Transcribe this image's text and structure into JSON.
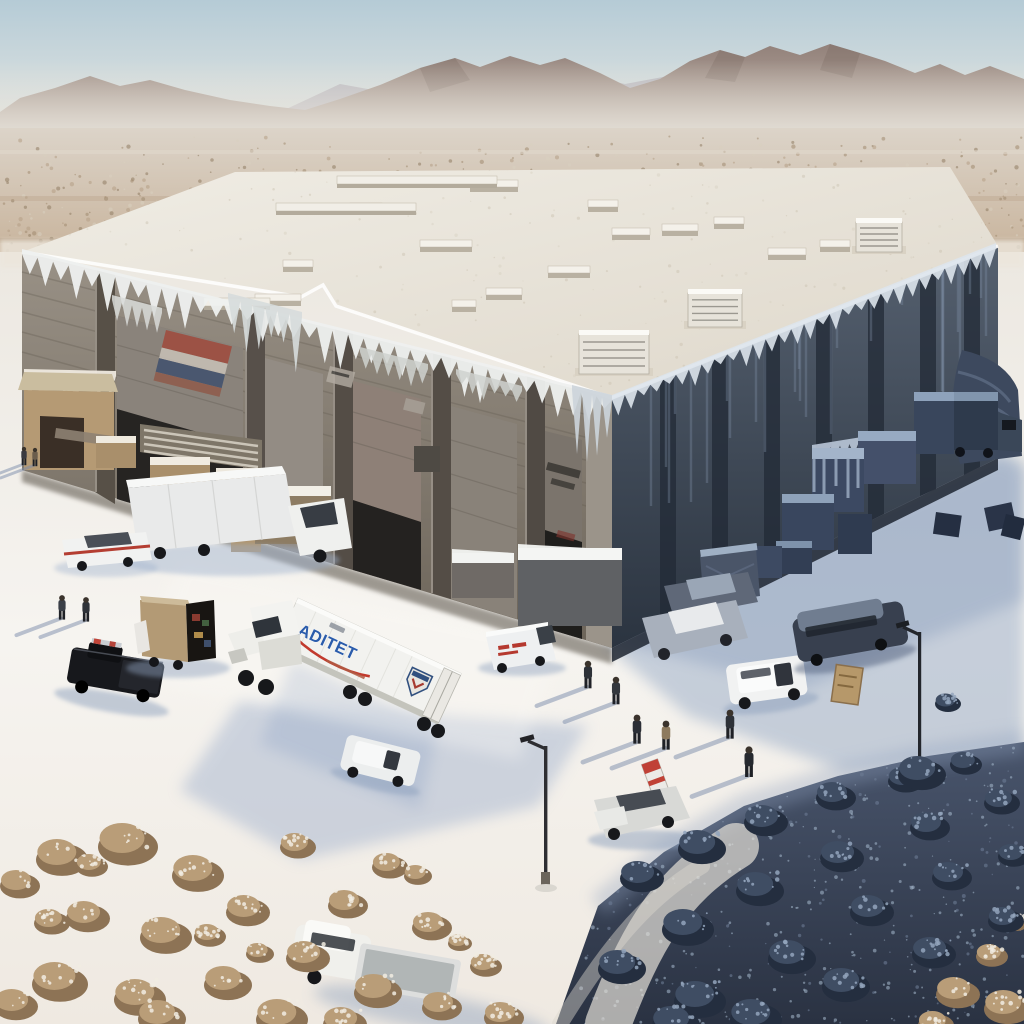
{
  "scene": {
    "type": "digital painting",
    "title": "Frozen warehouse in a desert",
    "description": "A large flat-roofed industrial warehouse stands alone on a frosty desert plain beneath hazy mountains. The building is encased in ice: icicles fringe every roofline and loading dock, frozen crates and pallets sit against the walls, and the right side of the building lies in deep blue shade. A white semi truck with a blue logo, box trucks, vans, pickups and cars are parked on the snow-covered lot while small figures walk across it casting long shadows. Frost-dusted sage scrub fills the foreground corners.",
    "palette": {
      "sky": "#b9cdd6",
      "haze": "#e4e0d9",
      "mountains": "#9c8a80",
      "desert": "#cdb9a0",
      "snow": "#f2efe9",
      "shadow_blue": "#a6b5cf",
      "roof": "#e9e5dc",
      "front_wall": "#857a6e",
      "side_wall": "#333c4a",
      "ice": "#e8edf2"
    },
    "truck": {
      "logo_text": "ADITET",
      "logo_color": "#2b5cab",
      "swoosh_color": "#c23a2d"
    }
  }
}
